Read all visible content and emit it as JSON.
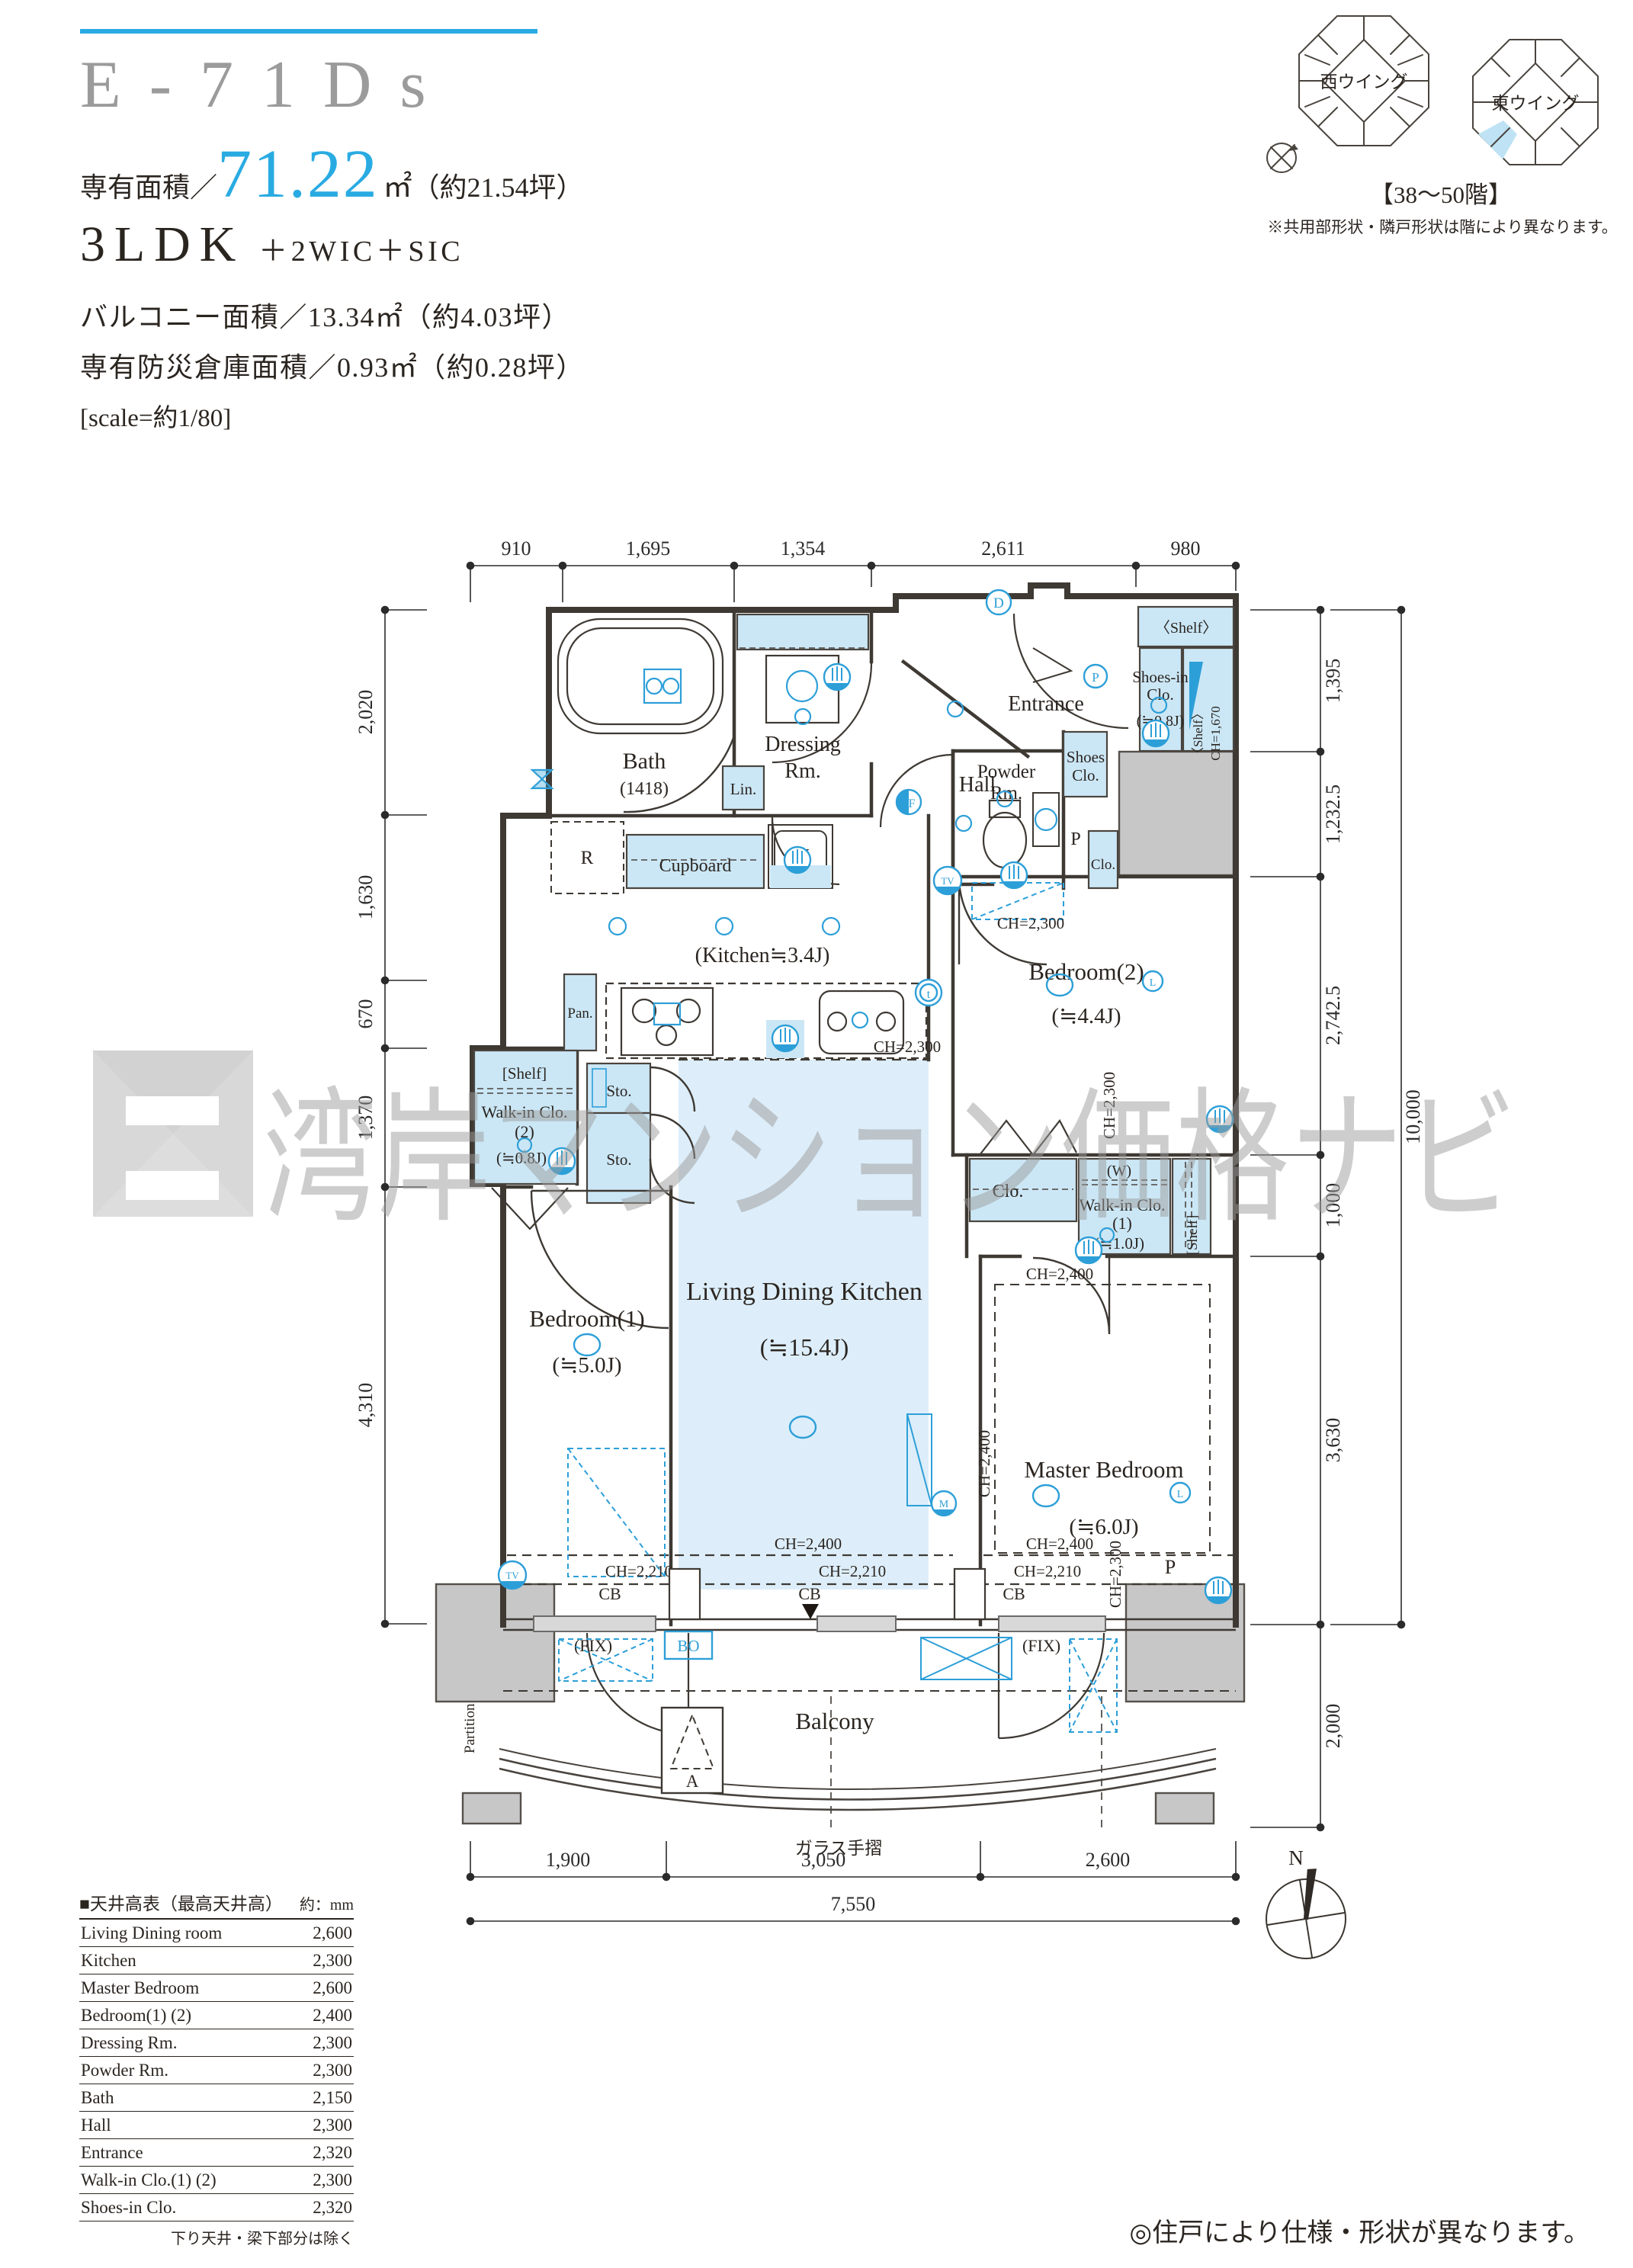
{
  "header": {
    "unit_name": "E-71Ds",
    "area_label": "専有面積／",
    "area_value": "71.22",
    "area_unit": "㎡",
    "area_tsubo": "（約21.54坪）",
    "plan_type": "3LDK",
    "plan_type_suffix": "＋2WIC＋SIC",
    "balcony_area": "バルコニー面積／13.34㎡（約4.03坪）",
    "disaster_storage_area": "専有防災倉庫面積／0.93㎡（約0.28坪）",
    "scale_note": "[scale=約1/80]"
  },
  "building_locator": {
    "west_wing_label": "西ウイング",
    "east_wing_label": "東ウイング",
    "floor_range": "【38〜50階】",
    "note": "※共用部形状・隣戸形状は階により異なります。"
  },
  "plan": {
    "room_labels": {
      "bath": "Bath",
      "bath_size": "(1418)",
      "dressing_line1": "Dressing",
      "dressing_line2": "Rm.",
      "entrance": "Entrance",
      "hall": "Hall",
      "powder_line1": "Powder",
      "powder_line2": "Rm.",
      "shoes_line1": "Shoes",
      "shoes_line2": "Clo.",
      "sic_line1": "Shoes-in",
      "sic_line2": "Clo.",
      "sic_size": "(≒0.8J)",
      "sic_shelf": "〈Shelf〉",
      "kitchen": "(Kitchen≒3.4J)",
      "pan": "Pan.",
      "sto": "Sto.",
      "lin": "Lin.",
      "cupboard": "Cupboard",
      "r": "R",
      "w": "W",
      "w_paren": "(W)",
      "p": "P",
      "clo": "Clo.",
      "shelf": "[Shelf]",
      "wic1_line1": "Walk-in Clo.",
      "wic1_line2": "(1)",
      "wic1_size": "(≒1.0J)",
      "wic2_line1": "Walk-in Clo.",
      "wic2_line2": "(2)",
      "wic2_size": "(≒0.8J)",
      "bedroom1": "Bedroom(1)",
      "bedroom1_size": "(≒5.0J)",
      "bedroom2": "Bedroom(2)",
      "bedroom2_size": "(≒4.4J)",
      "master": "Master Bedroom",
      "master_size": "(≒6.0J)",
      "ldk_line1": "Living Dining Kitchen",
      "ldk_line2": "(≒15.4J)",
      "balcony": "Balcony",
      "glass_rail": "ガラス手摺",
      "partition": "Partition",
      "a": "A",
      "fix": "(FIX)",
      "bo": "BO",
      "cb": "CB"
    },
    "ch": {
      "ch1670": "CH=1,670",
      "ch2300": "CH=2,300",
      "ch2400": "CH=2,400",
      "ch2210": "CH=2,210"
    },
    "markers": {
      "d": "D",
      "p": "P",
      "f": "F",
      "t": "t",
      "tv": "TV",
      "m": "M",
      "l": "L"
    },
    "dimensions": {
      "top": [
        "910",
        "1,695",
        "1,354",
        "2,611",
        "980"
      ],
      "left": [
        "2,020",
        "1,630",
        "670",
        "1,370",
        "4,310"
      ],
      "right": [
        "1,395",
        "1,232.5",
        "2,742.5",
        "1,000",
        "3,630",
        "2,000"
      ],
      "right_total": "10,000",
      "bottom": [
        "1,900",
        "3,050",
        "2,600"
      ],
      "bottom_total": "7,550"
    }
  },
  "ceiling_table": {
    "title": "■天井高表（最高天井高）",
    "unit_label": "約：mm",
    "rows": [
      {
        "label": "Living Dining room",
        "value": "2,600"
      },
      {
        "label": "Kitchen",
        "value": "2,300"
      },
      {
        "label": "Master Bedroom",
        "value": "2,600"
      },
      {
        "label": "Bedroom(1) (2)",
        "value": "2,400"
      },
      {
        "label": "Dressing Rm.",
        "value": "2,300"
      },
      {
        "label": "Powder Rm.",
        "value": "2,300"
      },
      {
        "label": "Bath",
        "value": "2,150"
      },
      {
        "label": "Hall",
        "value": "2,300"
      },
      {
        "label": "Entrance",
        "value": "2,320"
      },
      {
        "label": "Walk-in Clo.(1) (2)",
        "value": "2,300"
      },
      {
        "label": "Shoes-in Clo.",
        "value": "2,320"
      }
    ],
    "footnote": "下り天井・梁下部分は除く"
  },
  "compass": {
    "north_label": "N"
  },
  "footer_note": "◎住戸により仕様・形状が異なります。",
  "watermark": {
    "text": "湾岸マンション価格ナビ"
  },
  "colors": {
    "accent_blue": "#29abe2",
    "plan_blue": "#2d9fd8",
    "closet_fill": "#cbe7f6",
    "ldk_fill": "#ddeefa",
    "gray_block": "#c7c7c7",
    "wall": "#3e3933",
    "title_gray": "#9b9b9b",
    "watermark_gray": "#9c9c9c"
  }
}
